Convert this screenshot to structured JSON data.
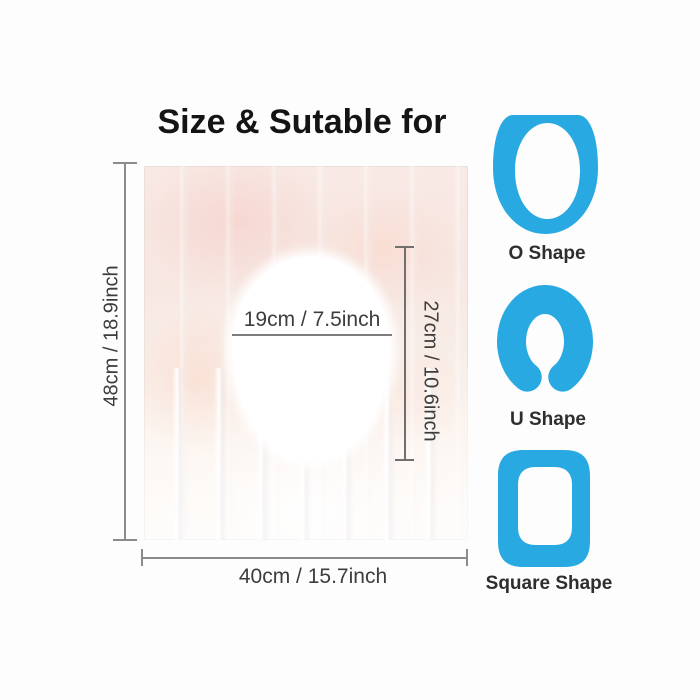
{
  "title": "Size & Sutable for",
  "colors": {
    "accent_blue": "#29A9E1",
    "dimension_line": "#8b8b8b",
    "text_dark": "#141414"
  },
  "product": {
    "height_label": "48cm / 18.9inch",
    "width_label": "40cm / 15.7inch",
    "hole_width_label": "19cm / 7.5inch",
    "hole_height_label": "27cm / 10.6inch"
  },
  "shapes": [
    {
      "label": "O Shape",
      "icon": "o-shape-icon"
    },
    {
      "label": "U Shape",
      "icon": "u-shape-icon"
    },
    {
      "label": "Square Shape",
      "icon": "square-shape-icon"
    }
  ]
}
